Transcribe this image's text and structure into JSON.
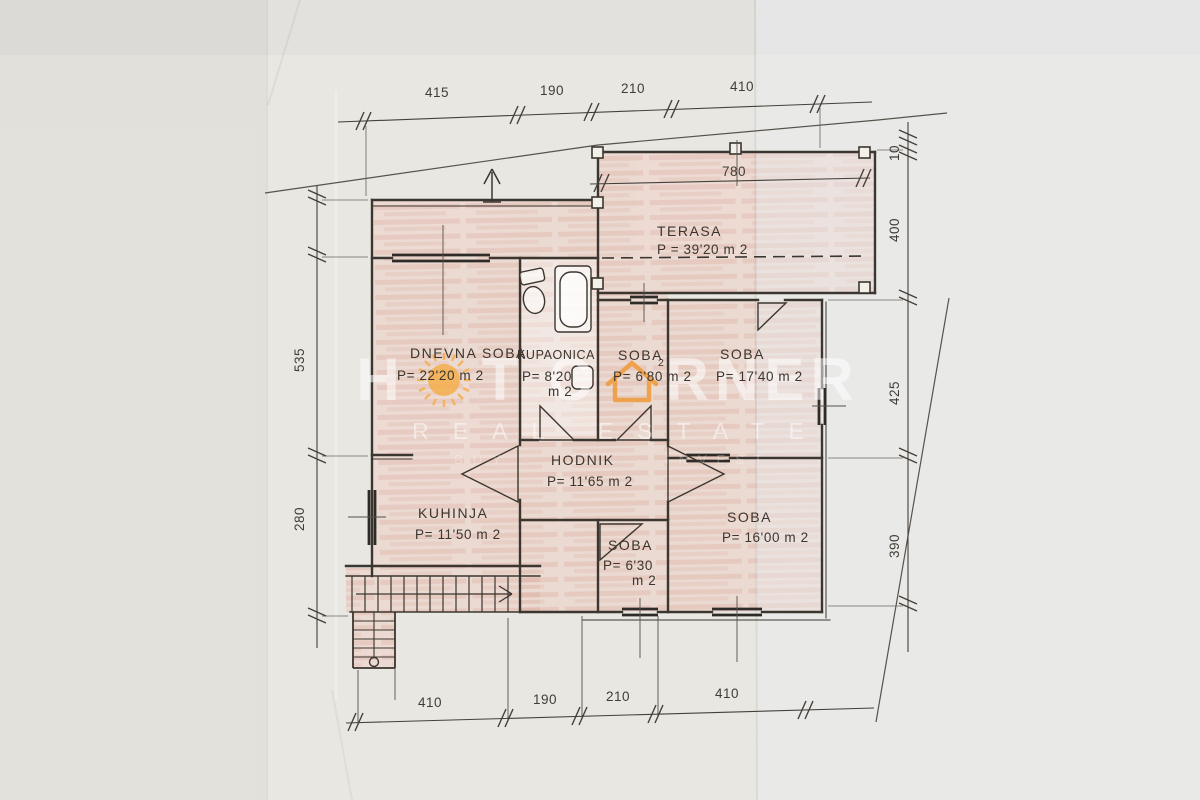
{
  "watermark": {
    "w1a": "H",
    "w1b": "T",
    "w2a": "C",
    "w2b": "RNER",
    "line2": "REAL ESTATE",
    "line3": "BUY · SELL · INVEST",
    "sun_color": "#f6ad45",
    "house_color": "#f09a38"
  },
  "rooms": {
    "terasa": {
      "name": "TERASA",
      "area": "P = 39'20 m 2"
    },
    "dnevna_soba": {
      "name": "DNEVNA SOBA",
      "area": "P= 22'20 m 2"
    },
    "kupaonica": {
      "name": "KUPAONICA",
      "area_line1": "P= 8'20",
      "area_line2": "m 2"
    },
    "soba_1": {
      "name": "SOBA",
      "sup": "2",
      "area": "P= 6'80 m 2"
    },
    "soba_2": {
      "name": "SOBA",
      "area": "P= 17'40 m 2"
    },
    "hodnik": {
      "name": "HODNIK",
      "area": "P= 11'65 m 2"
    },
    "kuhinja": {
      "name": "KUHINJA",
      "area": "P= 11'50 m 2"
    },
    "soba_3": {
      "name": "SOBA",
      "area_line1": "P= 6'30",
      "area_line2": "m 2"
    },
    "soba_4": {
      "name": "SOBA",
      "area": "P= 16'00 m 2"
    }
  },
  "dimensions": {
    "top": [
      "415",
      "190",
      "210",
      "410"
    ],
    "bottom": [
      "410",
      "190",
      "210",
      "410"
    ],
    "left": [
      "535",
      "280"
    ],
    "right": [
      "10",
      "400",
      "425",
      "390"
    ],
    "terrace_width": "780"
  },
  "colors": {
    "paper": "#e8e7e2",
    "ink": "#3b362f",
    "room_fill": "#efd0c6"
  }
}
